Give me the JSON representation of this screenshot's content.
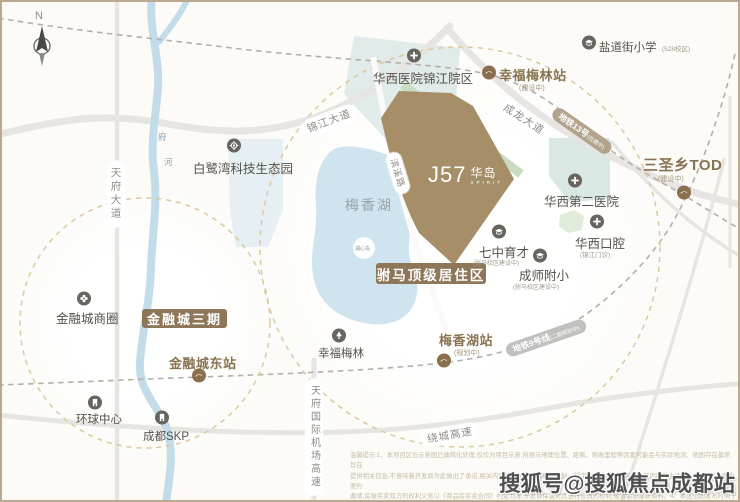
{
  "colors": {
    "accent_brown": "#8a7352",
    "banner_brown": "#8d7758",
    "site_brown": "#a68e68",
    "site_green_edge": "#c9dcc2",
    "lake_blue": "#cfe4ef",
    "river_blue": "#c2dde9",
    "teal_block": "#dce9e4",
    "bluegray_block": "#e3edf2",
    "road_gray": "#e7e5e2",
    "dashed_circle_tan": "#dcc9a0",
    "metro13_pill": "#b2a48c",
    "metro9_pill": "#c0c0be",
    "poi_icon_gray": "#67655e",
    "station_icon_brown": "#8a6f4e"
  },
  "compass": {
    "letter": "N"
  },
  "project_logo": {
    "main": "J57",
    "cn": "华岛",
    "sub": "SPIRIT"
  },
  "banners": [
    {
      "name": "banner-financial-city-phase3",
      "label": "金融城三期",
      "x": 140,
      "y": 307,
      "w": 85,
      "h": 19,
      "size": 13
    },
    {
      "name": "banner-fuma-residence",
      "label": "驸马顶级居住区",
      "x": 374,
      "y": 261,
      "w": 110,
      "h": 21,
      "size": 13.5
    }
  ],
  "stations": [
    {
      "name": "station-xingfumeilin",
      "label": "幸福梅林站",
      "sub": "(建设中)",
      "lx": 497,
      "ly": 63,
      "ls": 13,
      "sx": 517,
      "sy": 81,
      "cx": 487,
      "cy": 73
    },
    {
      "name": "station-sanshengxiang-tod",
      "label": "三圣乡TOD",
      "sub": "(建设中)",
      "lx": 641,
      "ly": 152,
      "ls": 15,
      "sx": 656,
      "sy": 172,
      "cx": 682,
      "cy": 193
    },
    {
      "name": "station-meixianghu",
      "label": "梅香湖站",
      "sub": "(规划中)",
      "lx": 437,
      "ly": 328,
      "ls": 13,
      "sx": 452,
      "sy": 346,
      "cx": 442,
      "cy": 361
    },
    {
      "name": "station-jinrongcheng-east",
      "label": "金融城东站",
      "lx": 167,
      "ly": 351,
      "ls": 13,
      "cx": 197,
      "cy": 376
    }
  ],
  "pois": [
    {
      "name": "poi-yandaojie-primary",
      "label": "盐道街小学",
      "sub": "(528校区)",
      "icon": "school-icon",
      "ix": 587,
      "iy": 43,
      "lx": 597,
      "ly": 37,
      "ls": 11.5,
      "sx": 660,
      "sy": 41,
      "ss": 6.5
    },
    {
      "name": "poi-huaxi-hospital-jinjiang",
      "label": "华西医院锦江院区",
      "icon": "hospital-icon",
      "ix": 412,
      "iy": 56,
      "lx": 371,
      "ly": 66,
      "ls": 12.5
    },
    {
      "name": "poi-bailuwan-tech-park",
      "label": "白鹭湾科技生态园",
      "icon": "tech-park-icon",
      "ix": 232,
      "iy": 146,
      "lx": 191,
      "ly": 156,
      "ls": 12.5
    },
    {
      "name": "poi-huaxi-second-hospital",
      "label": "华西第二医院",
      "icon": "hospital-icon",
      "ix": 573,
      "iy": 181,
      "lx": 542,
      "ly": 189,
      "ls": 12.5
    },
    {
      "name": "poi-huaxi-stomatology",
      "label": "华西口腔",
      "sub": "(锦江门诊)",
      "icon": "hospital-icon",
      "ix": 595,
      "iy": 222,
      "lx": 573,
      "ly": 231,
      "ls": 12.5,
      "sx": 578,
      "sy": 247,
      "ss": 6.5
    },
    {
      "name": "poi-qizhong-yucai",
      "label": "七中育才",
      "sub": "(驸马校区建设中)",
      "icon": "school-icon",
      "ix": 497,
      "iy": 232,
      "lx": 477,
      "ly": 240,
      "ls": 12.5,
      "sx": 471,
      "sy": 256,
      "ss": 6
    },
    {
      "name": "poi-chengshi-fuxiao",
      "label": "成师附小",
      "sub": "(驸马校区建设中)",
      "icon": "school-icon",
      "ix": 538,
      "iy": 256,
      "lx": 517,
      "ly": 263,
      "ls": 12.5,
      "sx": 511,
      "sy": 280,
      "ss": 6
    },
    {
      "name": "poi-jinrongcheng-business",
      "label": "金融城商圈",
      "icon": "shopping-icon",
      "ix": 82,
      "iy": 299,
      "lx": 54,
      "ly": 306,
      "ls": 12.5
    },
    {
      "name": "poi-global-center",
      "label": "环球中心",
      "icon": "landmark-icon",
      "ix": 93,
      "iy": 403,
      "lx": 74,
      "ly": 409,
      "ls": 11.5
    },
    {
      "name": "poi-chengdu-skp",
      "label": "成都SKP",
      "icon": "landmark-icon",
      "ix": 160,
      "iy": 418,
      "lx": 141,
      "ly": 426,
      "ls": 11.5
    },
    {
      "name": "poi-xingfu-meilin-park",
      "label": "幸福梅林",
      "icon": "park-icon",
      "ix": 337,
      "iy": 336,
      "lx": 316,
      "ly": 343,
      "ls": 11.5
    }
  ],
  "road_labels": [
    {
      "name": "road-label-tianfu-avenue",
      "text": "天府大道",
      "x": 114,
      "y": 192,
      "vertical": true,
      "size": 10.5
    },
    {
      "name": "road-label-jinjiang-avenue",
      "text": "锦江大道",
      "x": 327,
      "y": 119,
      "rot": -21,
      "size": 10.5
    },
    {
      "name": "road-label-chenglong-avenue",
      "text": "成龙大道",
      "x": 522,
      "y": 117,
      "rot": 33,
      "size": 10.5
    },
    {
      "name": "road-label-raocheng-expressway",
      "text": "绕城高速",
      "x": 448,
      "y": 433,
      "rot": -10,
      "size": 10.5
    },
    {
      "name": "road-label-tianfu-airport-expressway",
      "text": "天府国际机场高速",
      "x": 312,
      "y": 435,
      "vertical": true,
      "size": 10
    },
    {
      "name": "road-label-binxi-road",
      "text": "滨溪路",
      "x": 396,
      "y": 171,
      "rot": 73,
      "size": 9,
      "plain": true
    }
  ],
  "metro_labels": [
    {
      "name": "metro-line13-label",
      "text": "地铁13号",
      "sub": "(在建中)",
      "x": 580,
      "y": 129,
      "rot": 35,
      "bg": "#b2a48c",
      "size": 8.5
    },
    {
      "name": "metro-line9-label",
      "text": "地铁9号线",
      "sub": "(二期规划中)",
      "x": 544,
      "y": 336,
      "rot": -19,
      "bg": "#c0c0be",
      "size": 8.5
    }
  ],
  "area_labels": [
    {
      "name": "area-label-meixiang-lake",
      "text": "梅香湖",
      "x": 343,
      "y": 193,
      "size": 14,
      "color": "#99a4a8",
      "ls": 2
    },
    {
      "name": "area-label-huxin-island",
      "text": "湖心岛",
      "x": 353,
      "y": 243,
      "size": 5,
      "color": "#8f9aa0"
    },
    {
      "name": "river-label-fu",
      "text": "府",
      "x": 156,
      "y": 129,
      "size": 8.5,
      "color": "#86a0ad"
    },
    {
      "name": "river-label-he",
      "text": "河",
      "x": 162,
      "y": 154,
      "size": 8.5,
      "color": "#86a0ad"
    }
  ],
  "disclaimer": {
    "lines": [
      "温馨提示:1、本项目区位示意图已做简化处理,仅作为项目示意,所展示地理位置、距离、地表里程等因素可能会与实际地况、地图存在偏差,旨在",
      "提供相关信息,不意味着开发商为此做出了承诺,相关内容不排除因政府相关规划、规定及开发商无法控制的原因而发生改变。3、本区位图为要约",
      "邀请,房屋买卖双方的权利义务以《商品房买卖合同》约定为准,开发商保留对其进行修改的权利,敬请留意最新资料。4、本区位图发布时间于",
      "2025年7月。"
    ]
  },
  "watermark": "搜狐号@搜狐焦点成都站"
}
